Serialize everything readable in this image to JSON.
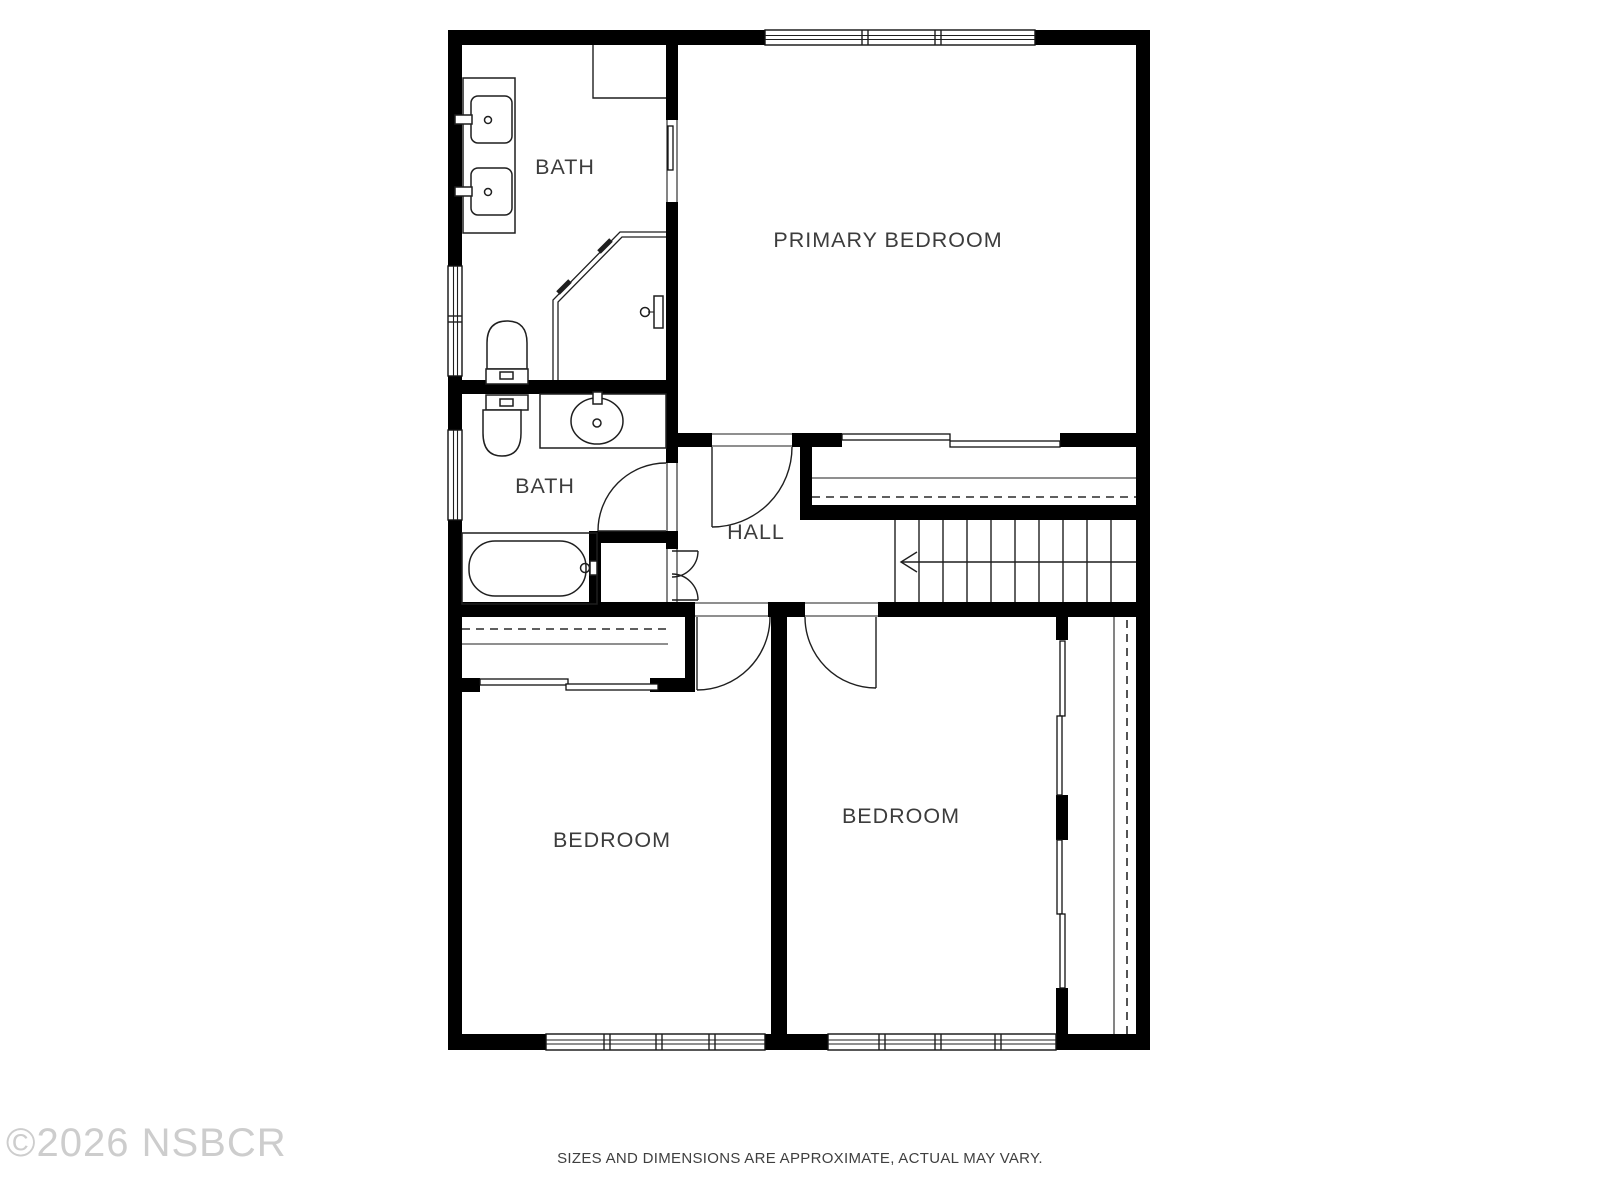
{
  "colors": {
    "wall": "#000000",
    "line": "#1f1f1f",
    "label": "#3c3c3c",
    "watermark": "#cdcdcd",
    "disclaimer": "#3f3f3f"
  },
  "rooms": {
    "bath_primary": {
      "label": "BATH"
    },
    "primary_bedroom": {
      "label": "PRIMARY BEDROOM"
    },
    "bath_hall": {
      "label": "BATH"
    },
    "hall": {
      "label": "HALL"
    },
    "bedroom_left": {
      "label": "BEDROOM"
    },
    "bedroom_right": {
      "label": "BEDROOM"
    }
  },
  "footer": {
    "watermark": "©2026 NSBCR",
    "disclaimer": "SIZES AND DIMENSIONS ARE APPROXIMATE, ACTUAL MAY VARY."
  }
}
